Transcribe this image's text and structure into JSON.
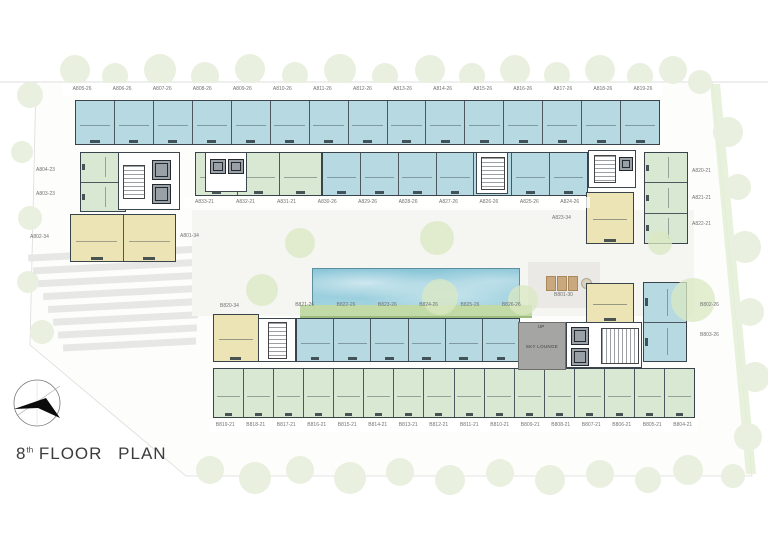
{
  "title": {
    "number": "8",
    "suffix": "th",
    "word1": "FLOOR",
    "word2": "PLAN"
  },
  "units": {
    "row_a_top": [
      "A805-26",
      "A806-26",
      "A807-26",
      "A808-26",
      "A809-26",
      "A810-26",
      "A811-26",
      "A812-26",
      "A813-26",
      "A814-26",
      "A815-26",
      "A816-26",
      "A817-26",
      "A818-26",
      "A819-26"
    ],
    "row_a_mid_green": [
      "A833-21",
      "A832-21",
      "A831-21"
    ],
    "row_a_mid_blue": [
      "A830-26",
      "A829-26",
      "A828-26",
      "A827-26",
      "A826-26",
      "A825-26",
      "A824-26"
    ],
    "left_green": [
      "A804-23",
      "A803-23"
    ],
    "left_yellow": [
      "A802-34",
      "A801-34"
    ],
    "right_green": [
      "A820-21",
      "A821-21",
      "A822-21"
    ],
    "right_yellow": "A823-34",
    "mid_yellow": "B820-34",
    "row_b_mid": [
      "B821-26",
      "B822-26",
      "B823-26",
      "B824-26",
      "B825-26",
      "B826-26"
    ],
    "b801": "B801-30",
    "right_b": [
      "B802-26",
      "B803-26"
    ],
    "row_b_bottom": [
      "B819-21",
      "B818-21",
      "B817-21",
      "B816-21",
      "B815-21",
      "B814-21",
      "B813-21",
      "B812-21",
      "B811-21",
      "B810-21",
      "B809-21",
      "B808-21",
      "B807-21",
      "B806-21",
      "B805-21",
      "B804-21"
    ]
  },
  "amenities": {
    "sky_lounge": "SKY LOUNGE",
    "up": "UP"
  },
  "colors": {
    "unit_blue": "#b7d9e1",
    "unit_green": "#d9e8d3",
    "unit_yellow": "#ece4b4",
    "pool_blue": "#8ac6d8",
    "deck_green": "#c2dba6",
    "lounge_gray": "#a5a5a3",
    "wall": "#39434b",
    "label_text": "#727272"
  }
}
